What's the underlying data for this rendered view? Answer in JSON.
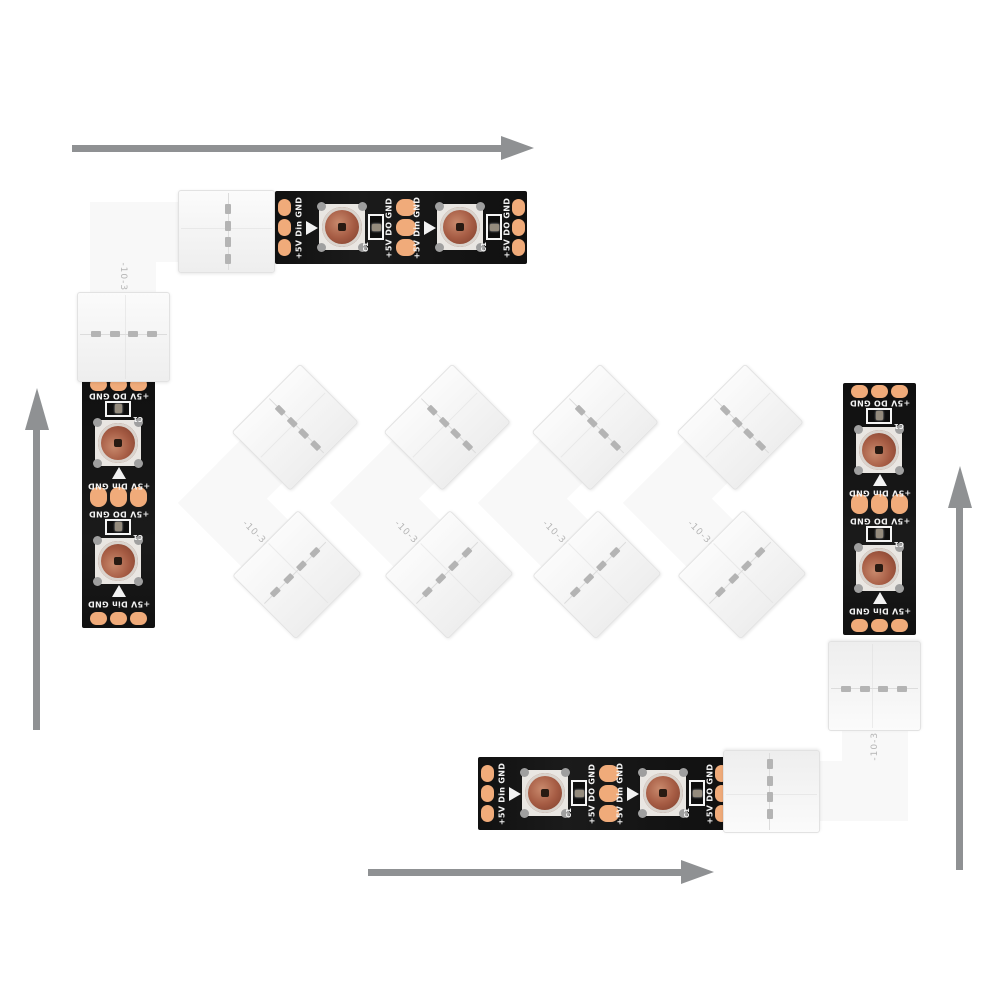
{
  "strip": {
    "label_input": "+5V Din GND",
    "label_output": "+5V DO GND",
    "component_label": "C1",
    "leds_per_strip": 2,
    "strip_count": 4
  },
  "connector": {
    "part_label": "-10-3P",
    "loose_connector_count": 4,
    "corner_connector_count": 2,
    "pins_per_clip": 3
  },
  "arrows": {
    "top_direction": "right",
    "left_direction": "up",
    "right_direction": "up",
    "bottom_direction": "right"
  },
  "colors": {
    "background": "#ffffff",
    "pcb_black": "#141414",
    "copper_pad": "#f0ab7a",
    "led_lens": "#a65c44",
    "silkscreen_white": "#f2f2f2",
    "connector_white": "#f8f8f8",
    "arrow_gray": "#8f9193"
  }
}
